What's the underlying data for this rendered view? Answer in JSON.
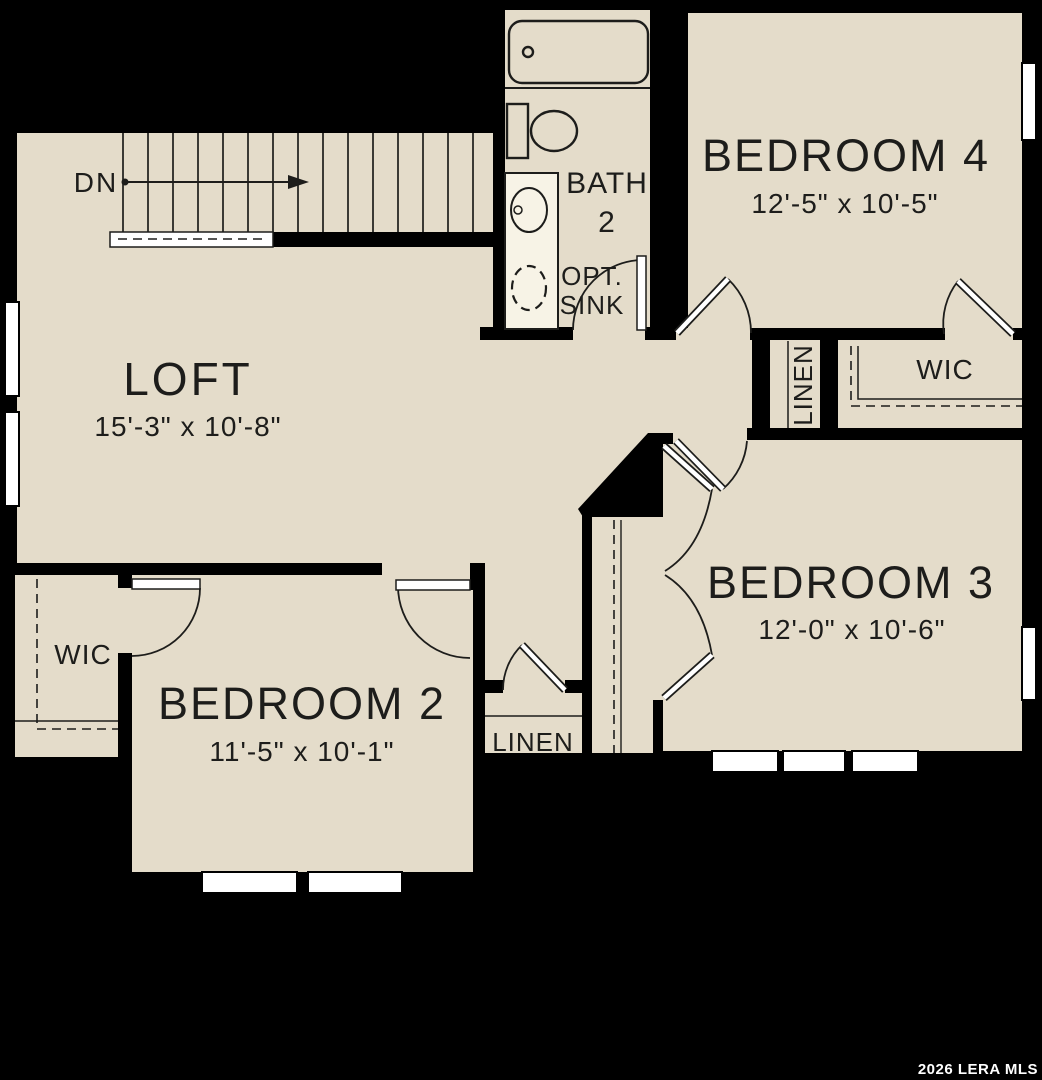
{
  "plan": {
    "rooms": {
      "loft": {
        "name": "LOFT",
        "dims": "15'-3\" x 10'-8\""
      },
      "bedroom2": {
        "name": "BEDROOM 2",
        "dims": "11'-5\" x 10'-1\""
      },
      "bedroom3": {
        "name": "BEDROOM 3",
        "dims": "12'-0\" x 10'-6\""
      },
      "bedroom4": {
        "name": "BEDROOM 4",
        "dims": "12'-5\" x 10'-5\""
      },
      "bath": {
        "name": "BATH",
        "number": "2"
      }
    },
    "labels": {
      "down": "DN",
      "opt_line1": "OPT.",
      "opt_line2": "SINK",
      "wic": "WIC",
      "linen": "LINEN"
    },
    "watermark": "2026 LERA MLS",
    "colors": {
      "floor": "#e4dcca",
      "wall": "#000000",
      "line": "#1d1d1b",
      "window": "#ffffff",
      "fixture_white": "#f7f3e6",
      "text": "#1d1d1b",
      "watermark_text": "#ffffff"
    }
  }
}
